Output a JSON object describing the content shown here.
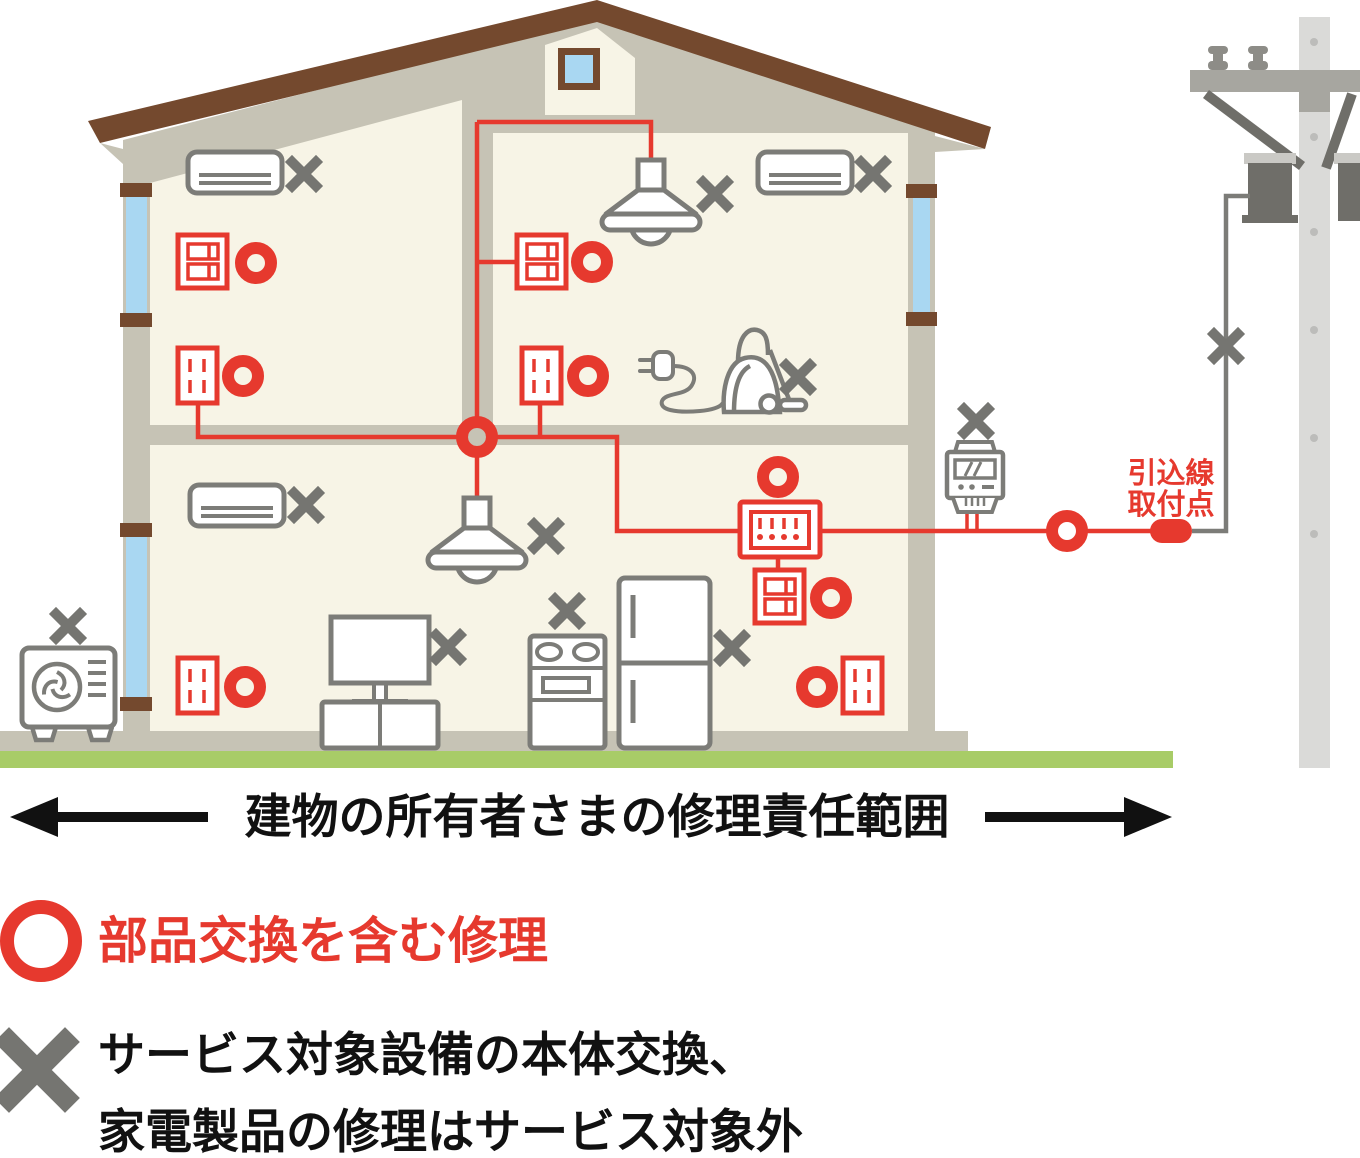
{
  "labels": {
    "owner_range": "建物の所有者さまの修理責任範囲",
    "service_drop": [
      "引込線",
      "取付点"
    ]
  },
  "legend": {
    "circle": {
      "marker": "red-ring",
      "text": "部品交換を含む修理"
    },
    "x": {
      "marker": "gray-x",
      "lines": [
        "サービス対象設備の本体交換、",
        "家電製品の修理はサービス対象外"
      ]
    }
  },
  "markers": {
    "repair_covered": "red-circle",
    "not_covered": "gray-x"
  },
  "equipment": [
    {
      "name": "wall-air-conditioner-2f-left",
      "marker": "gray-x"
    },
    {
      "name": "light-switch-2f-left",
      "marker": "red-circle"
    },
    {
      "name": "outlet-2f-left",
      "marker": "red-circle"
    },
    {
      "name": "pendant-light-2f",
      "marker": "gray-x"
    },
    {
      "name": "light-switch-2f-right",
      "marker": "red-circle"
    },
    {
      "name": "outlet-2f-right",
      "marker": "red-circle"
    },
    {
      "name": "wall-air-conditioner-2f-right",
      "marker": "gray-x"
    },
    {
      "name": "vacuum-cleaner",
      "marker": "gray-x"
    },
    {
      "name": "wall-air-conditioner-1f",
      "marker": "gray-x"
    },
    {
      "name": "pendant-light-1f",
      "marker": "gray-x"
    },
    {
      "name": "television",
      "marker": "gray-x"
    },
    {
      "name": "stove",
      "marker": "gray-x"
    },
    {
      "name": "refrigerator",
      "marker": "gray-x"
    },
    {
      "name": "distribution-board",
      "marker": "red-circle"
    },
    {
      "name": "light-switch-1f",
      "marker": "red-circle"
    },
    {
      "name": "outlet-1f-left",
      "marker": "red-circle"
    },
    {
      "name": "outlet-1f-right",
      "marker": "red-circle"
    },
    {
      "name": "outdoor-ac-unit",
      "marker": "gray-x"
    },
    {
      "name": "electric-meter",
      "marker": "gray-x"
    },
    {
      "name": "service-wire",
      "marker": "gray-x"
    },
    {
      "name": "service-drop-attachment-point",
      "marker": "red-pill"
    }
  ],
  "colors": {
    "red": "#e6392e",
    "appliance_gray": "#7c7c78",
    "x_gray": "#757571",
    "wall_taupe": "#c6c3b5",
    "interior_cream": "#f7f4e6",
    "roof_brown": "#74492e",
    "window_blue": "#a9d7f2",
    "grass_green": "#a8cc67",
    "pole_gray": "#dadad8",
    "text_black": "#111111"
  }
}
